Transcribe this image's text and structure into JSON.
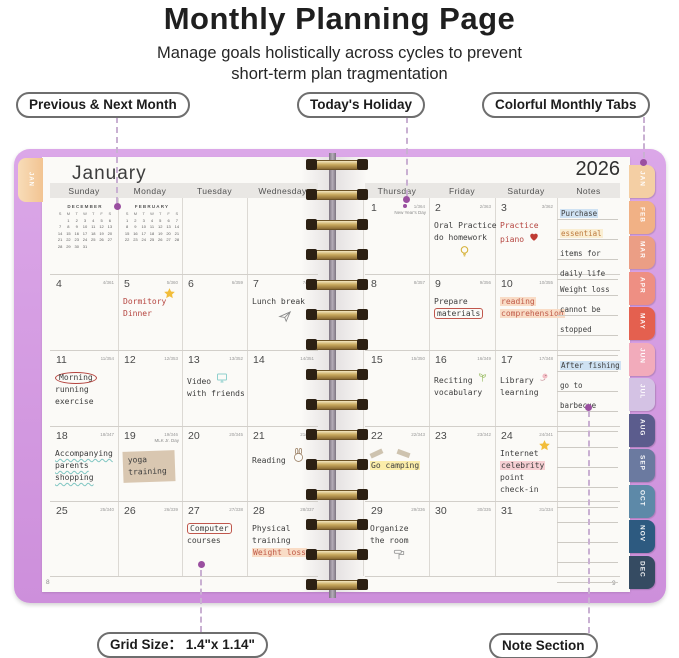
{
  "header": {
    "title": "Monthly Planning Page",
    "subtitle_line1": "Manage goals holistically across cycles to prevent",
    "subtitle_line2": "short-term plan tragmentation"
  },
  "callouts": {
    "previous_next": "Previous & Next Month",
    "todays_holiday": "Today's Holiday",
    "monthly_tabs": "Colorful Monthly Tabs",
    "grid_size": "Grid Size： 1.4\"x 1.14\"",
    "note_section": "Note Section"
  },
  "colors": {
    "cover_purple": "#cd8fdb",
    "ring_gold": "#c8a95e",
    "highlight_blue": "#cfe2f3",
    "highlight_yellow": "#fbedaa",
    "highlight_peach": "#f9dcc6",
    "highlight_pink": "#f6cfd3"
  },
  "planner": {
    "month_title": "January",
    "year": "2026",
    "left_tab": "JAN",
    "page_left_num": "8",
    "page_right_num": "9",
    "weekday_headers_left": [
      "Sunday",
      "Monday",
      "Tuesday",
      "Wednesday"
    ],
    "weekday_headers_right": [
      "Thursday",
      "Friday",
      "Saturday",
      "Notes"
    ],
    "mini_calendars": [
      {
        "title": "DECEMBER",
        "dow": [
          "S",
          "M",
          "T",
          "W",
          "T",
          "F",
          "S"
        ],
        "weeks": [
          [
            "",
            "1",
            "2",
            "3",
            "4",
            "5",
            "6"
          ],
          [
            "7",
            "8",
            "9",
            "10",
            "11",
            "12",
            "13"
          ],
          [
            "14",
            "15",
            "16",
            "17",
            "18",
            "19",
            "20"
          ],
          [
            "21",
            "22",
            "23",
            "24",
            "25",
            "26",
            "27"
          ],
          [
            "28",
            "29",
            "30",
            "31",
            "",
            "",
            ""
          ]
        ]
      },
      {
        "title": "FEBRUARY",
        "dow": [
          "S",
          "M",
          "T",
          "W",
          "T",
          "F",
          "S"
        ],
        "weeks": [
          [
            "1",
            "2",
            "3",
            "4",
            "5",
            "6",
            "7"
          ],
          [
            "8",
            "9",
            "10",
            "11",
            "12",
            "13",
            "14"
          ],
          [
            "15",
            "16",
            "17",
            "18",
            "19",
            "20",
            "21"
          ],
          [
            "22",
            "23",
            "24",
            "25",
            "26",
            "27",
            "28"
          ]
        ]
      }
    ],
    "month_tabs": [
      {
        "label": "JAN",
        "color": "#f4cfa4"
      },
      {
        "label": "FEB",
        "color": "#f1b185"
      },
      {
        "label": "MAR",
        "color": "#eb9e85"
      },
      {
        "label": "APR",
        "color": "#ee8f83"
      },
      {
        "label": "MAY",
        "color": "#e4604f"
      },
      {
        "label": "JUN",
        "color": "#f2abbb"
      },
      {
        "label": "JUL",
        "color": "#d4c2e4"
      },
      {
        "label": "AUG",
        "color": "#5b5c8d"
      },
      {
        "label": "SEP",
        "color": "#6b7aa0"
      },
      {
        "label": "OCT",
        "color": "#5d89a8"
      },
      {
        "label": "NOV",
        "color": "#2d5a80"
      },
      {
        "label": "DEC",
        "color": "#354b62"
      }
    ],
    "days": [
      {
        "n": "1",
        "f": "1/364",
        "holiday": "New Year's Day",
        "dot": true
      },
      {
        "n": "2",
        "f": "2/363",
        "lines": [
          {
            "t": "Oral Practice"
          },
          {
            "t": "do homework"
          }
        ],
        "icon": "lightbulb-icon",
        "icon_pos": "below"
      },
      {
        "n": "3",
        "f": "3/362",
        "lines": [
          {
            "t": "Practice",
            "c": "red"
          },
          {
            "t": "piano",
            "c": "red",
            "icon": "heart-icon"
          }
        ]
      },
      {
        "n": "4",
        "f": "4/361"
      },
      {
        "n": "5",
        "f": "5/360",
        "corner_icon": "star-icon",
        "lines": [
          {
            "t": "Dormitory",
            "c": "red"
          },
          {
            "t": "Dinner",
            "c": "red"
          }
        ]
      },
      {
        "n": "6",
        "f": "6/359"
      },
      {
        "n": "7",
        "f": "7/358",
        "lines": [
          {
            "t": "Lunch break"
          }
        ],
        "icon": "paper-plane-icon",
        "icon_pos": "below"
      },
      {
        "n": "8",
        "f": "8/357"
      },
      {
        "n": "9",
        "f": "9/356",
        "lines": [
          {
            "t": "Prepare"
          },
          {
            "t": "materials",
            "c": "boxed"
          }
        ]
      },
      {
        "n": "10",
        "f": "10/355",
        "lines": [
          {
            "t": "reading",
            "c": "softred hlpeach"
          },
          {
            "t": "comprehension",
            "c": "softred hlpeach"
          }
        ]
      },
      {
        "n": "11",
        "f": "11/354",
        "lines": [
          {
            "t": "Morning",
            "c": "circled"
          },
          {
            "t": "running"
          },
          {
            "t": "exercise"
          }
        ]
      },
      {
        "n": "12",
        "f": "12/353"
      },
      {
        "n": "13",
        "f": "13/352",
        "lines": [
          {
            "t": "Video",
            "icon": "monitor-icon"
          },
          {
            "t": "with friends"
          }
        ]
      },
      {
        "n": "14",
        "f": "14/351"
      },
      {
        "n": "15",
        "f": "15/350"
      },
      {
        "n": "16",
        "f": "16/349",
        "lines": [
          {
            "t": "Reciting",
            "icon": "sprout-icon"
          },
          {
            "t": "vocabulary"
          }
        ]
      },
      {
        "n": "17",
        "f": "17/348",
        "lines": [
          {
            "t": "Library",
            "icon": "bird-icon"
          },
          {
            "t": "learning"
          }
        ]
      },
      {
        "n": "18",
        "f": "18/347",
        "lines": [
          {
            "t": "Accompanying",
            "c": "wavy"
          },
          {
            "t": "parents",
            "c": "wavy"
          },
          {
            "t": "shopping",
            "c": "wavy"
          }
        ]
      },
      {
        "n": "19",
        "f": "19/346",
        "sub": "MLK Jr. Day",
        "tape": true,
        "lines": [
          {
            "t": "yoga"
          },
          {
            "t": "training"
          }
        ]
      },
      {
        "n": "20",
        "f": "20/345"
      },
      {
        "n": "21",
        "f": "21/344",
        "lines": [
          {
            "t": "Reading",
            "icon": "bunny-icon"
          }
        ]
      },
      {
        "n": "22",
        "f": "22/343",
        "tapebits": true,
        "lines": [
          {
            "t": "Go camping",
            "c": "hlyellow"
          }
        ]
      },
      {
        "n": "23",
        "f": "23/342"
      },
      {
        "n": "24",
        "f": "24/341",
        "corner_icon": "star-icon",
        "lines": [
          {
            "t": "Internet"
          },
          {
            "t": "celebrity",
            "c": "hlpink"
          },
          {
            "t": "point"
          },
          {
            "t": "check-in"
          }
        ]
      },
      {
        "n": "25",
        "f": "25/340"
      },
      {
        "n": "26",
        "f": "26/339"
      },
      {
        "n": "27",
        "f": "27/338",
        "lines": [
          {
            "t": "Computer",
            "c": "boxed"
          },
          {
            "t": "courses"
          }
        ]
      },
      {
        "n": "28",
        "f": "28/337",
        "lines": [
          {
            "t": "Physical"
          },
          {
            "t": "training"
          },
          {
            "t": "Weight loss",
            "c": "softred hlpeach"
          }
        ]
      },
      {
        "n": "29",
        "f": "29/336",
        "lines": [
          {
            "t": "Organize"
          },
          {
            "t": "the room"
          }
        ],
        "icon": "roller-icon",
        "icon_pos": "below"
      },
      {
        "n": "30",
        "f": "30/335"
      },
      {
        "n": "31",
        "f": "31/334"
      }
    ],
    "notes_rows": [
      {
        "lines": [
          {
            "t": "Purchase",
            "c": "hlblue"
          },
          {
            "t": "essential",
            "c": "hlcream orange"
          },
          {
            "t": "items for"
          },
          {
            "t": "daily life"
          }
        ]
      },
      {
        "lines": [
          {
            "t": "Weight loss"
          },
          {
            "t": "cannot be"
          },
          {
            "t": "stopped"
          },
          {
            "t": ""
          }
        ]
      },
      {
        "lines": [
          {
            "t": "After fishing",
            "c": "hlblue"
          },
          {
            "t": "go to"
          },
          {
            "t": "barbecue"
          },
          {
            "t": ""
          }
        ]
      },
      {
        "lines": [
          {
            "t": ""
          },
          {
            "t": ""
          },
          {
            "t": ""
          },
          {
            "t": ""
          }
        ]
      },
      {
        "lines": [
          {
            "t": ""
          },
          {
            "t": ""
          },
          {
            "t": ""
          },
          {
            "t": ""
          }
        ]
      }
    ]
  }
}
